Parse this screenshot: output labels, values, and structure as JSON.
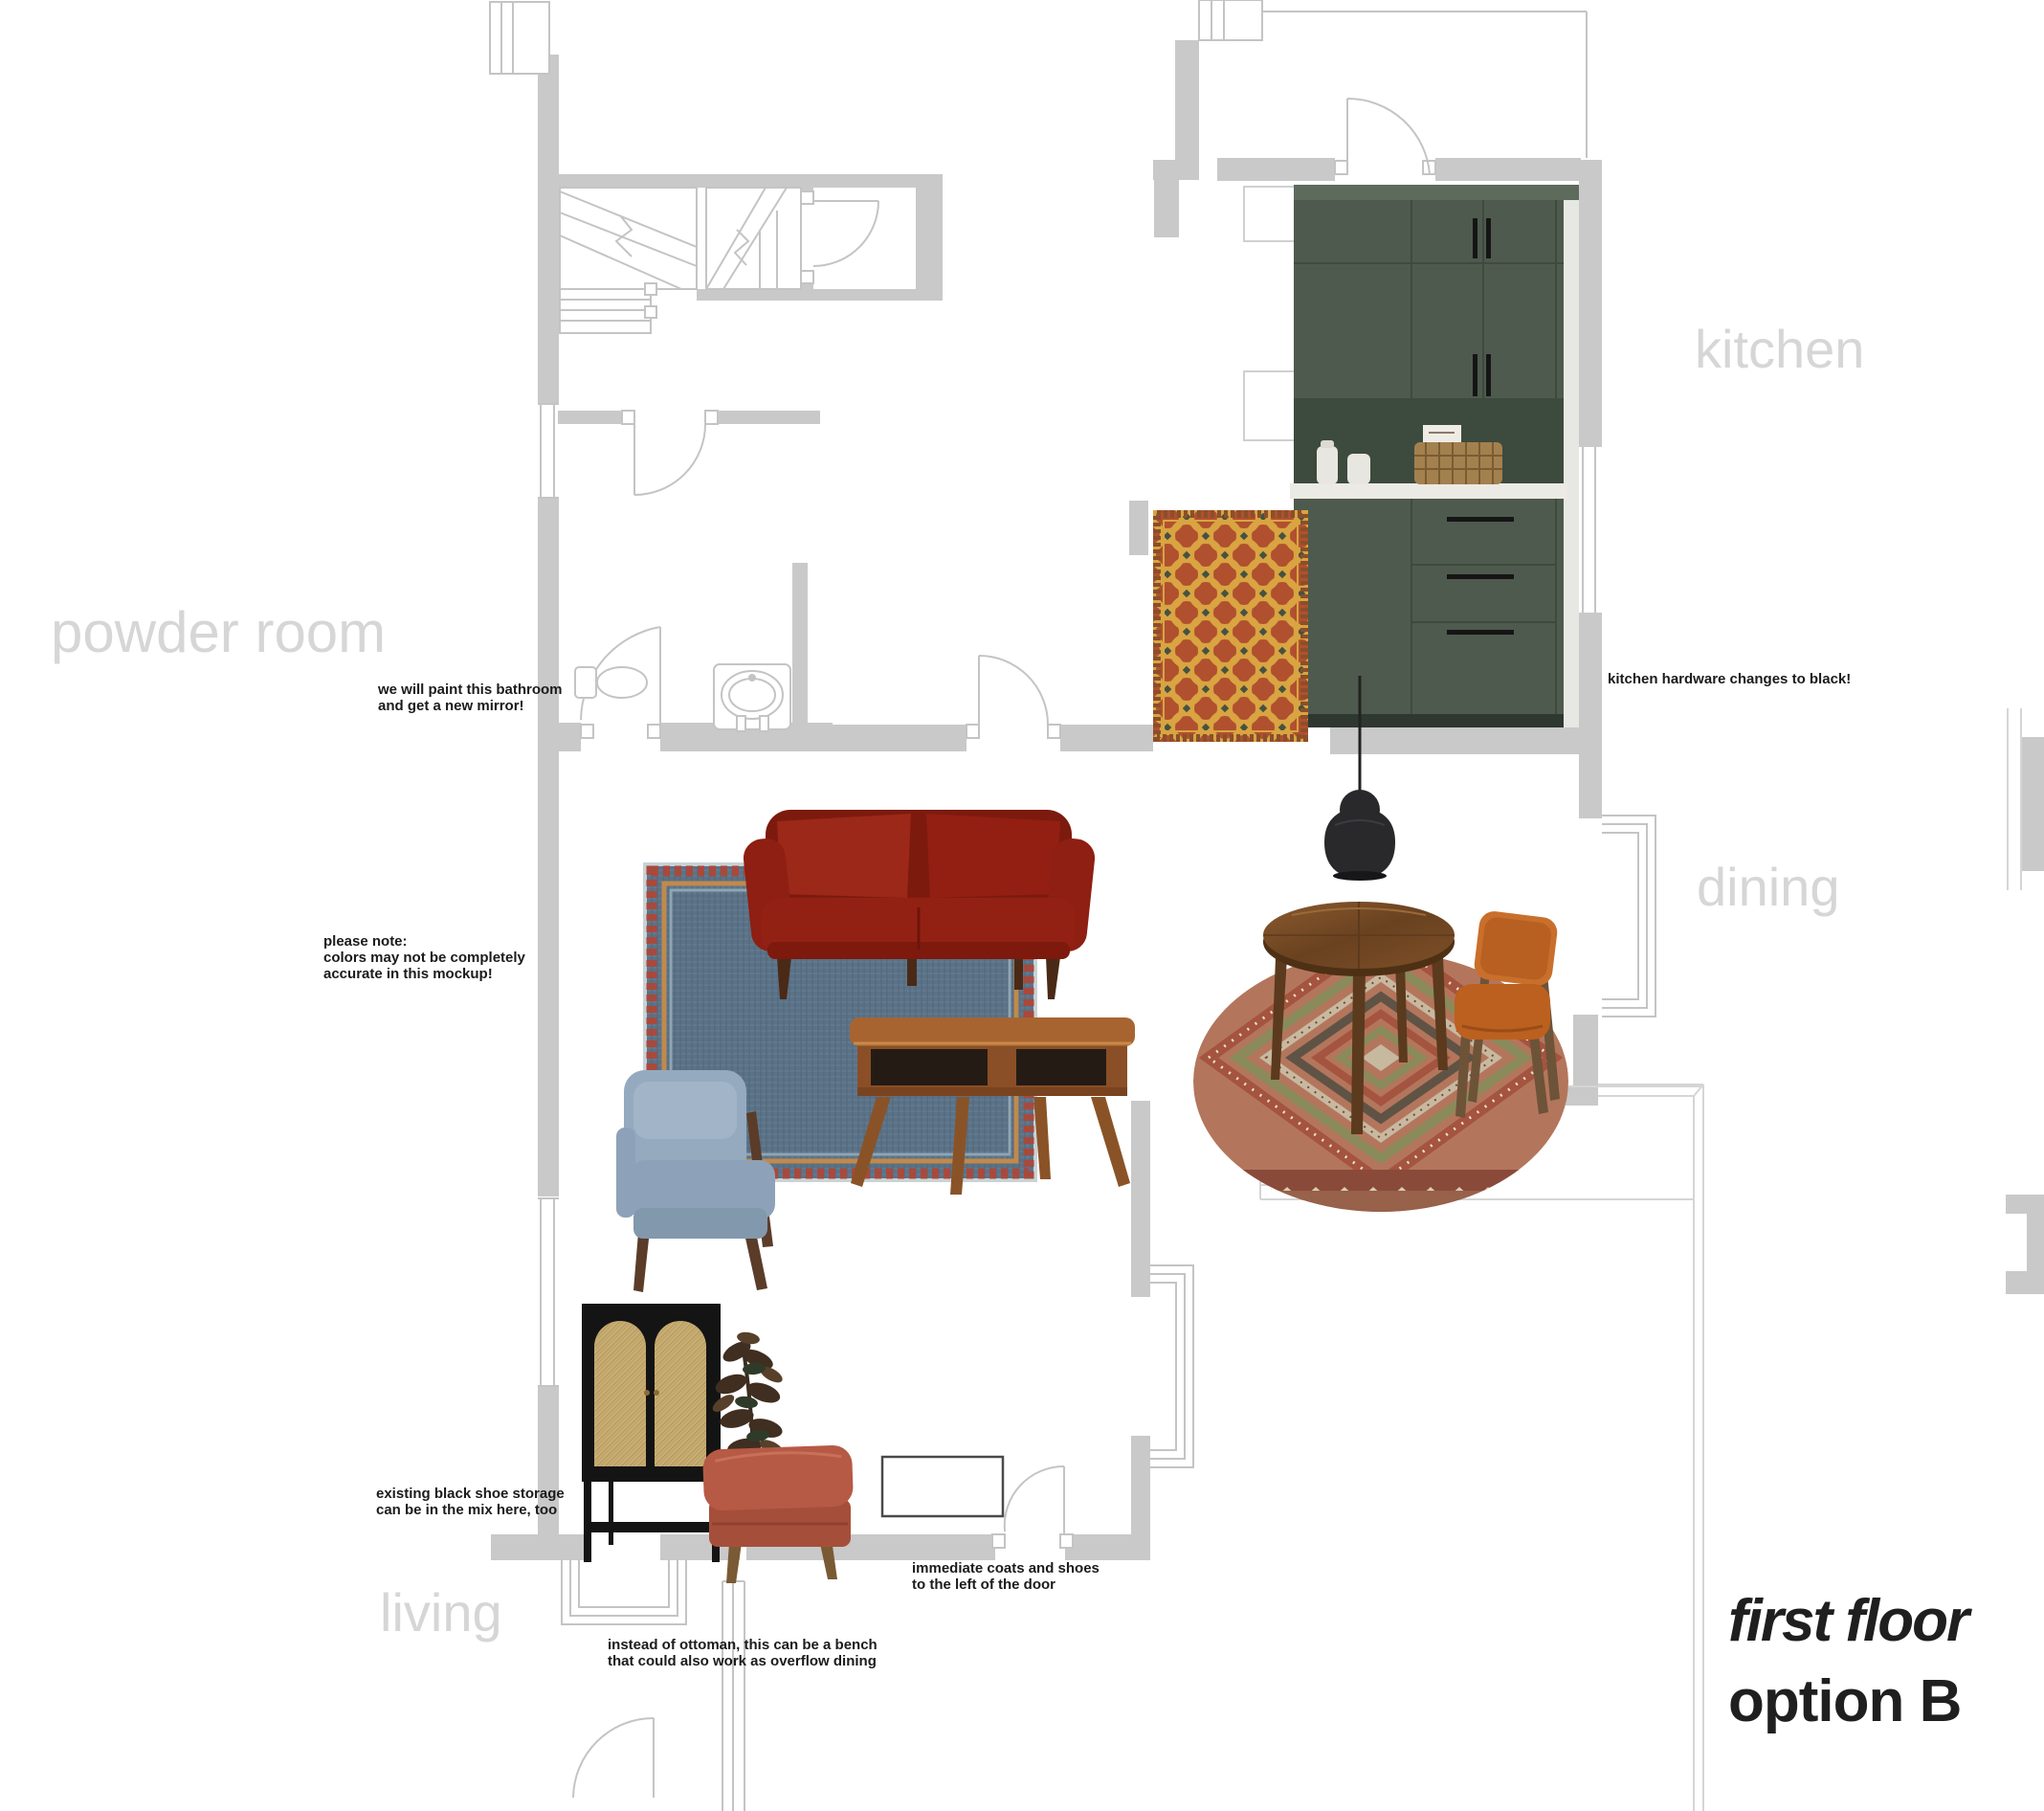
{
  "title": {
    "line1": "first floor",
    "line2": "option B"
  },
  "room_labels": {
    "powder_room": "powder room",
    "kitchen": "kitchen",
    "dining": "dining",
    "living": "living"
  },
  "annotations": {
    "bathroom": "we will paint this bathroom\nand get a new mirror!",
    "kitchen_hardware": "kitchen hardware changes to black!",
    "disclaimer": "please note:\ncolors may not be completely\naccurate in this mockup!",
    "shoe_storage": "existing black shoe storage\ncan be in the mix here, too",
    "coats": "immediate coats and shoes\nto the left of the door",
    "ottoman": "instead of ottoman, this can be a bench\nthat could also work as overflow dining"
  },
  "colors": {
    "wall_fill": "#c9c9c9",
    "plan_line": "#c4c4c4",
    "room_label_gray": "#d6d6d6",
    "annotation_text": "#1b1b1b",
    "cabinet_green": "#4e5a4e",
    "backsplash_green": "#3d4a3e",
    "countertop_white": "#eceae4",
    "sofa_red": "#8e1f12",
    "rug_blue_denim": "#5b7286",
    "rug_orange_red": "#b0502f",
    "rug_gold": "#d9a441",
    "kilim_rust": "#a4543f",
    "dining_chair_orange": "#c06324",
    "armchair_blue": "#93a7bc",
    "ottoman_terracotta": "#b65a45",
    "cane_tan": "#c9ae74",
    "wood_brown": "#8a5a2e",
    "pendant_black": "#29292c"
  }
}
